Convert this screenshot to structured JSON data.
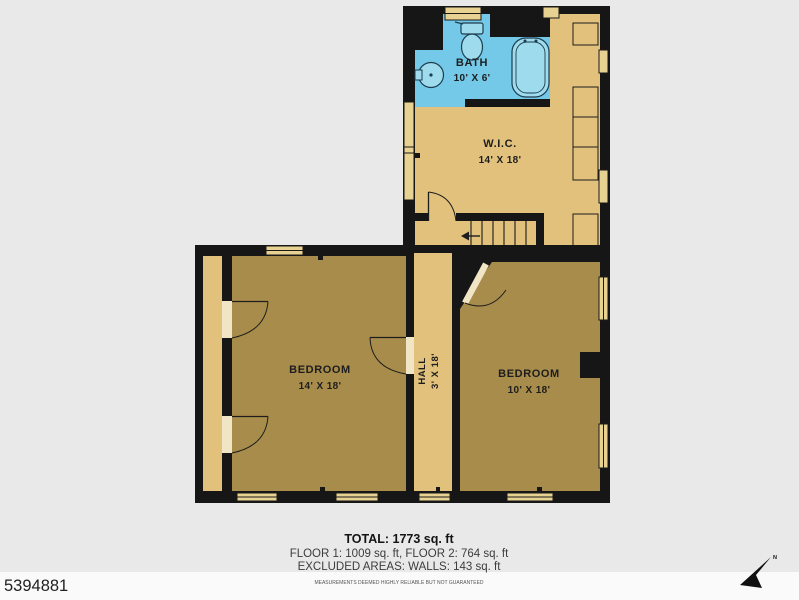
{
  "watermark_id": "5394881",
  "rooms": {
    "bath": {
      "name": "BATH",
      "dims": "10' X 6'"
    },
    "wic": {
      "name": "W.I.C.",
      "dims": "14' X 18'"
    },
    "bedroom_left": {
      "name": "BEDROOM",
      "dims": "14' X 18'"
    },
    "hall": {
      "name": "HALL",
      "dims": "3' X 18'"
    },
    "bedroom_right": {
      "name": "BEDROOM",
      "dims": "10' X 18'"
    }
  },
  "summary": {
    "total": "TOTAL: 1773 sq. ft",
    "floors": "FLOOR 1: 1009 sq. ft, FLOOR 2: 764 sq. ft",
    "excluded": "EXCLUDED AREAS: WALLS: 143 sq. ft",
    "disclaimer": "MEASUREMENTS DEEMED HIGHLY RELIABLE BUT NOT GUARANTEED"
  },
  "compass": {
    "north_label": "N"
  },
  "colors": {
    "wall": "#161616",
    "bath_fill": "#74c9e8",
    "room_light": "#e2c17c",
    "room_dark": "#a78c4b",
    "window_fill": "#e8d291",
    "door_gap": "#f0e5c4",
    "background": "#e9e9e9"
  }
}
